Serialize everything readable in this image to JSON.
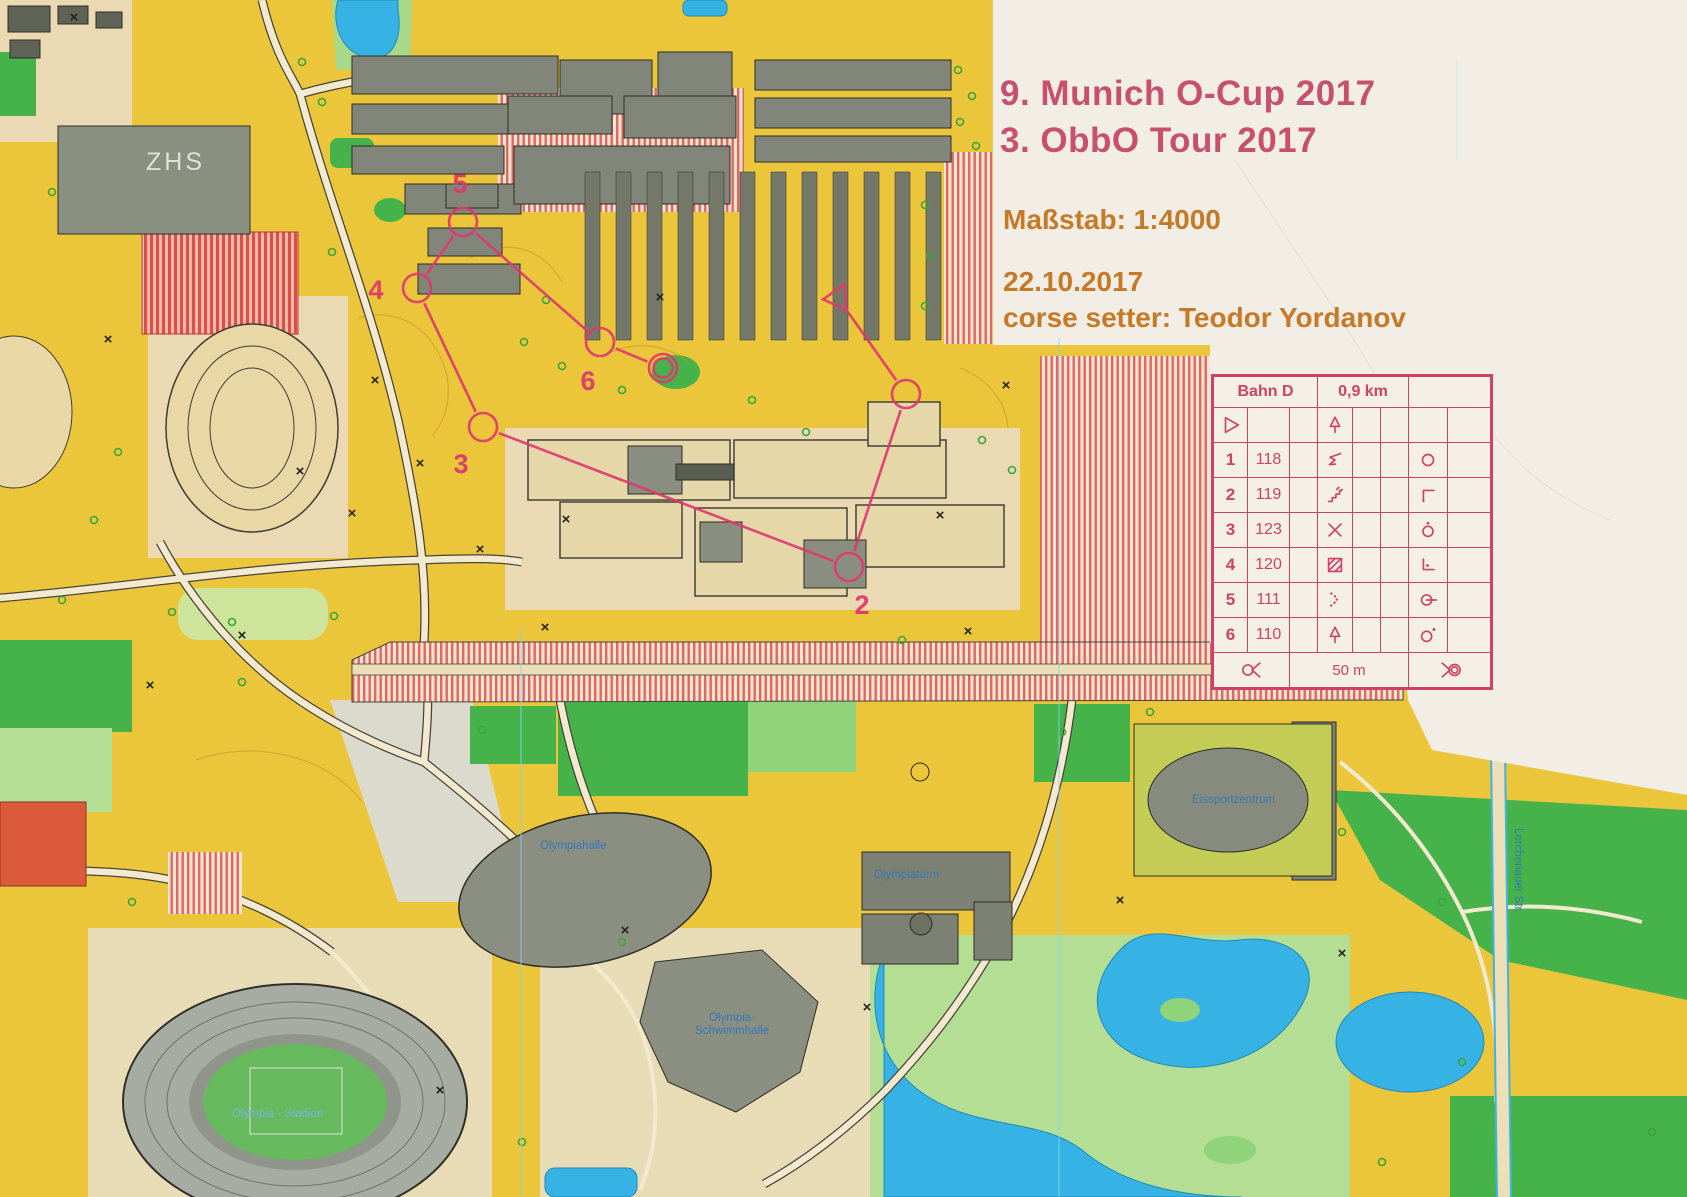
{
  "event": {
    "title_line1": "9. Munich O-Cup 2017",
    "title_line2": "3. ObbO Tour 2017",
    "scale": "Maßstab: 1:4000",
    "date": "22.10.2017",
    "course_setter": "corse setter: Teodor Yordanov"
  },
  "control_descriptions": {
    "course": "Bahn D",
    "length": "0,9 km",
    "rows": [
      {
        "type": "start",
        "number": "",
        "code": "",
        "start_icon": "start-triangle-icon",
        "feature_icon": "tree-icon",
        "position_icon": ""
      },
      {
        "type": "control",
        "number": "1",
        "code": "118",
        "feature_icon": "spur-icon",
        "position_icon": "circle-icon"
      },
      {
        "type": "control",
        "number": "2",
        "code": "119",
        "feature_icon": "stairs-icon",
        "position_icon": "corner-nw-icon"
      },
      {
        "type": "control",
        "number": "3",
        "code": "123",
        "feature_icon": "crossing-icon",
        "position_icon": "circle-dot-top-icon"
      },
      {
        "type": "control",
        "number": "4",
        "code": "120",
        "feature_icon": "paved-area-icon",
        "position_icon": "corner-sw-dot-icon"
      },
      {
        "type": "control",
        "number": "5",
        "code": "111",
        "feature_icon": "dotted-boundary-icon",
        "position_icon": "circle-dash-icon"
      },
      {
        "type": "control",
        "number": "6",
        "code": "110",
        "feature_icon": "tree-icon",
        "position_icon": "circle-dot-ne-icon"
      }
    ],
    "finish_row": {
      "left_icon": "finish-route-start-icon",
      "distance": "50 m",
      "right_icon": "finish-route-end-icon"
    }
  },
  "course_overlay": {
    "color": "#e0386f",
    "controls": [
      {
        "type": "start",
        "x": 838,
        "y": 298
      },
      {
        "type": "control",
        "x": 906,
        "y": 394
      },
      {
        "type": "control",
        "x": 849,
        "y": 567
      },
      {
        "type": "control",
        "x": 483,
        "y": 427
      },
      {
        "type": "control",
        "x": 417,
        "y": 288
      },
      {
        "type": "control",
        "x": 463,
        "y": 222
      },
      {
        "type": "control",
        "x": 600,
        "y": 342
      },
      {
        "type": "finish",
        "x": 663,
        "y": 368
      }
    ],
    "visible_numbers": [
      {
        "label": "2",
        "x": 862,
        "y": 607
      },
      {
        "label": "3",
        "x": 461,
        "y": 466
      },
      {
        "label": "4",
        "x": 376,
        "y": 292
      },
      {
        "label": "5",
        "x": 460,
        "y": 186
      },
      {
        "label": "6",
        "x": 588,
        "y": 383
      }
    ]
  },
  "map_labels": [
    {
      "id": "zhs",
      "text": "ZHS",
      "x": 146,
      "y": 148,
      "cls": "lbl-zhs"
    },
    {
      "id": "olympiahalle",
      "text": "Olympiahalle",
      "x": 540,
      "y": 840,
      "cls": "lbl-blue"
    },
    {
      "id": "olympiaturm",
      "text": "Olympiaturm",
      "x": 874,
      "y": 869,
      "cls": "lbl-blue"
    },
    {
      "id": "eissportzentrum",
      "text": "Eissportzentrum",
      "x": 1192,
      "y": 794,
      "cls": "lbl-blue"
    },
    {
      "id": "olympia-schwimmhalle",
      "lines": [
        "Olympia-",
        "Schwimmhalle"
      ],
      "x": 662,
      "y": 1012,
      "w": 140,
      "cls": "lbl-blue lbl-center"
    },
    {
      "id": "olympia-stadion",
      "text": "Olympia - Stadion",
      "x": 232,
      "y": 1108,
      "cls": "lbl-stadion"
    },
    {
      "id": "lerchenauer-str",
      "text": "Lerchenauer Str.",
      "x": 1524,
      "y": 828,
      "rotate": 90,
      "cls": "lbl-blue"
    }
  ],
  "colors": {
    "course_pink": "#e0386f",
    "title_pink": "#c8506f",
    "info_orange": "#c67a28",
    "card_pink": "#cf4168",
    "map_yellow": "#ebc63b",
    "water_blue": "#36b3e4",
    "out_of_bounds_red": "#e2685f",
    "label_blue": "#3578b5",
    "paper_white": "#f2eee5"
  }
}
